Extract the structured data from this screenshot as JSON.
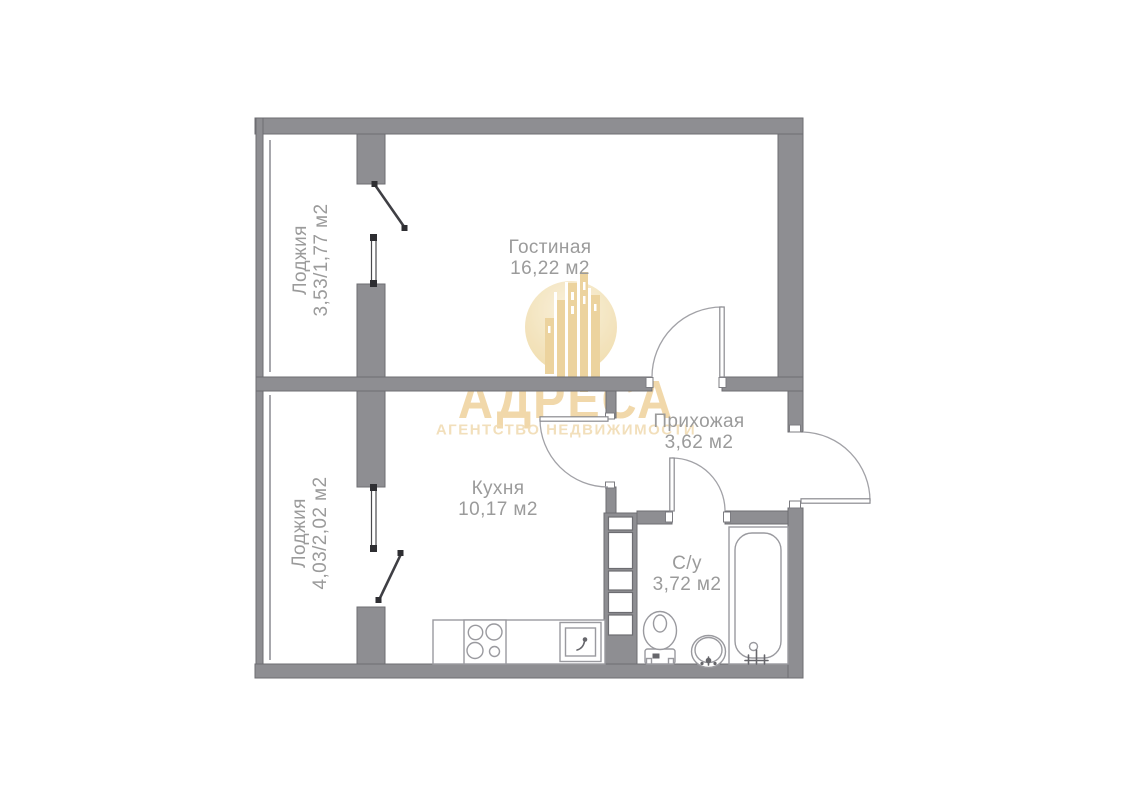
{
  "rooms": [
    {
      "id": "living",
      "name": "Гостиная",
      "area": "16,22 м2"
    },
    {
      "id": "kitchen",
      "name": "Кухня",
      "area": "10,17 м2"
    },
    {
      "id": "hallway",
      "name": "Прихожая",
      "area": "3,62 м2"
    },
    {
      "id": "bathroom",
      "name": "С/у",
      "area": "3,72 м2"
    },
    {
      "id": "loggia-top",
      "name": "Лоджия",
      "area": "3,53/1,77 м2"
    },
    {
      "id": "loggia-bottom",
      "name": "Лоджия",
      "area": "4,03/2,02 м2"
    }
  ],
  "watermark": {
    "brand": "АДРЕСА",
    "tagline": "АГЕНТСТВО НЕДВИЖИМОСТИ"
  },
  "fixtures": [
    "stove-icon",
    "kitchen-sink-icon",
    "toilet-icon",
    "washbasin-icon",
    "bathtub-icon",
    "ventilation-shaft-icon",
    "window-icon",
    "balcony-door-icon",
    "door-swing-icon"
  ],
  "colors": {
    "background": "#ffffff",
    "wall": "#8e8e92",
    "fixture_line": "#9a9a9f",
    "label_text": "#9b9b9b",
    "watermark_gold": "#eecf96"
  }
}
